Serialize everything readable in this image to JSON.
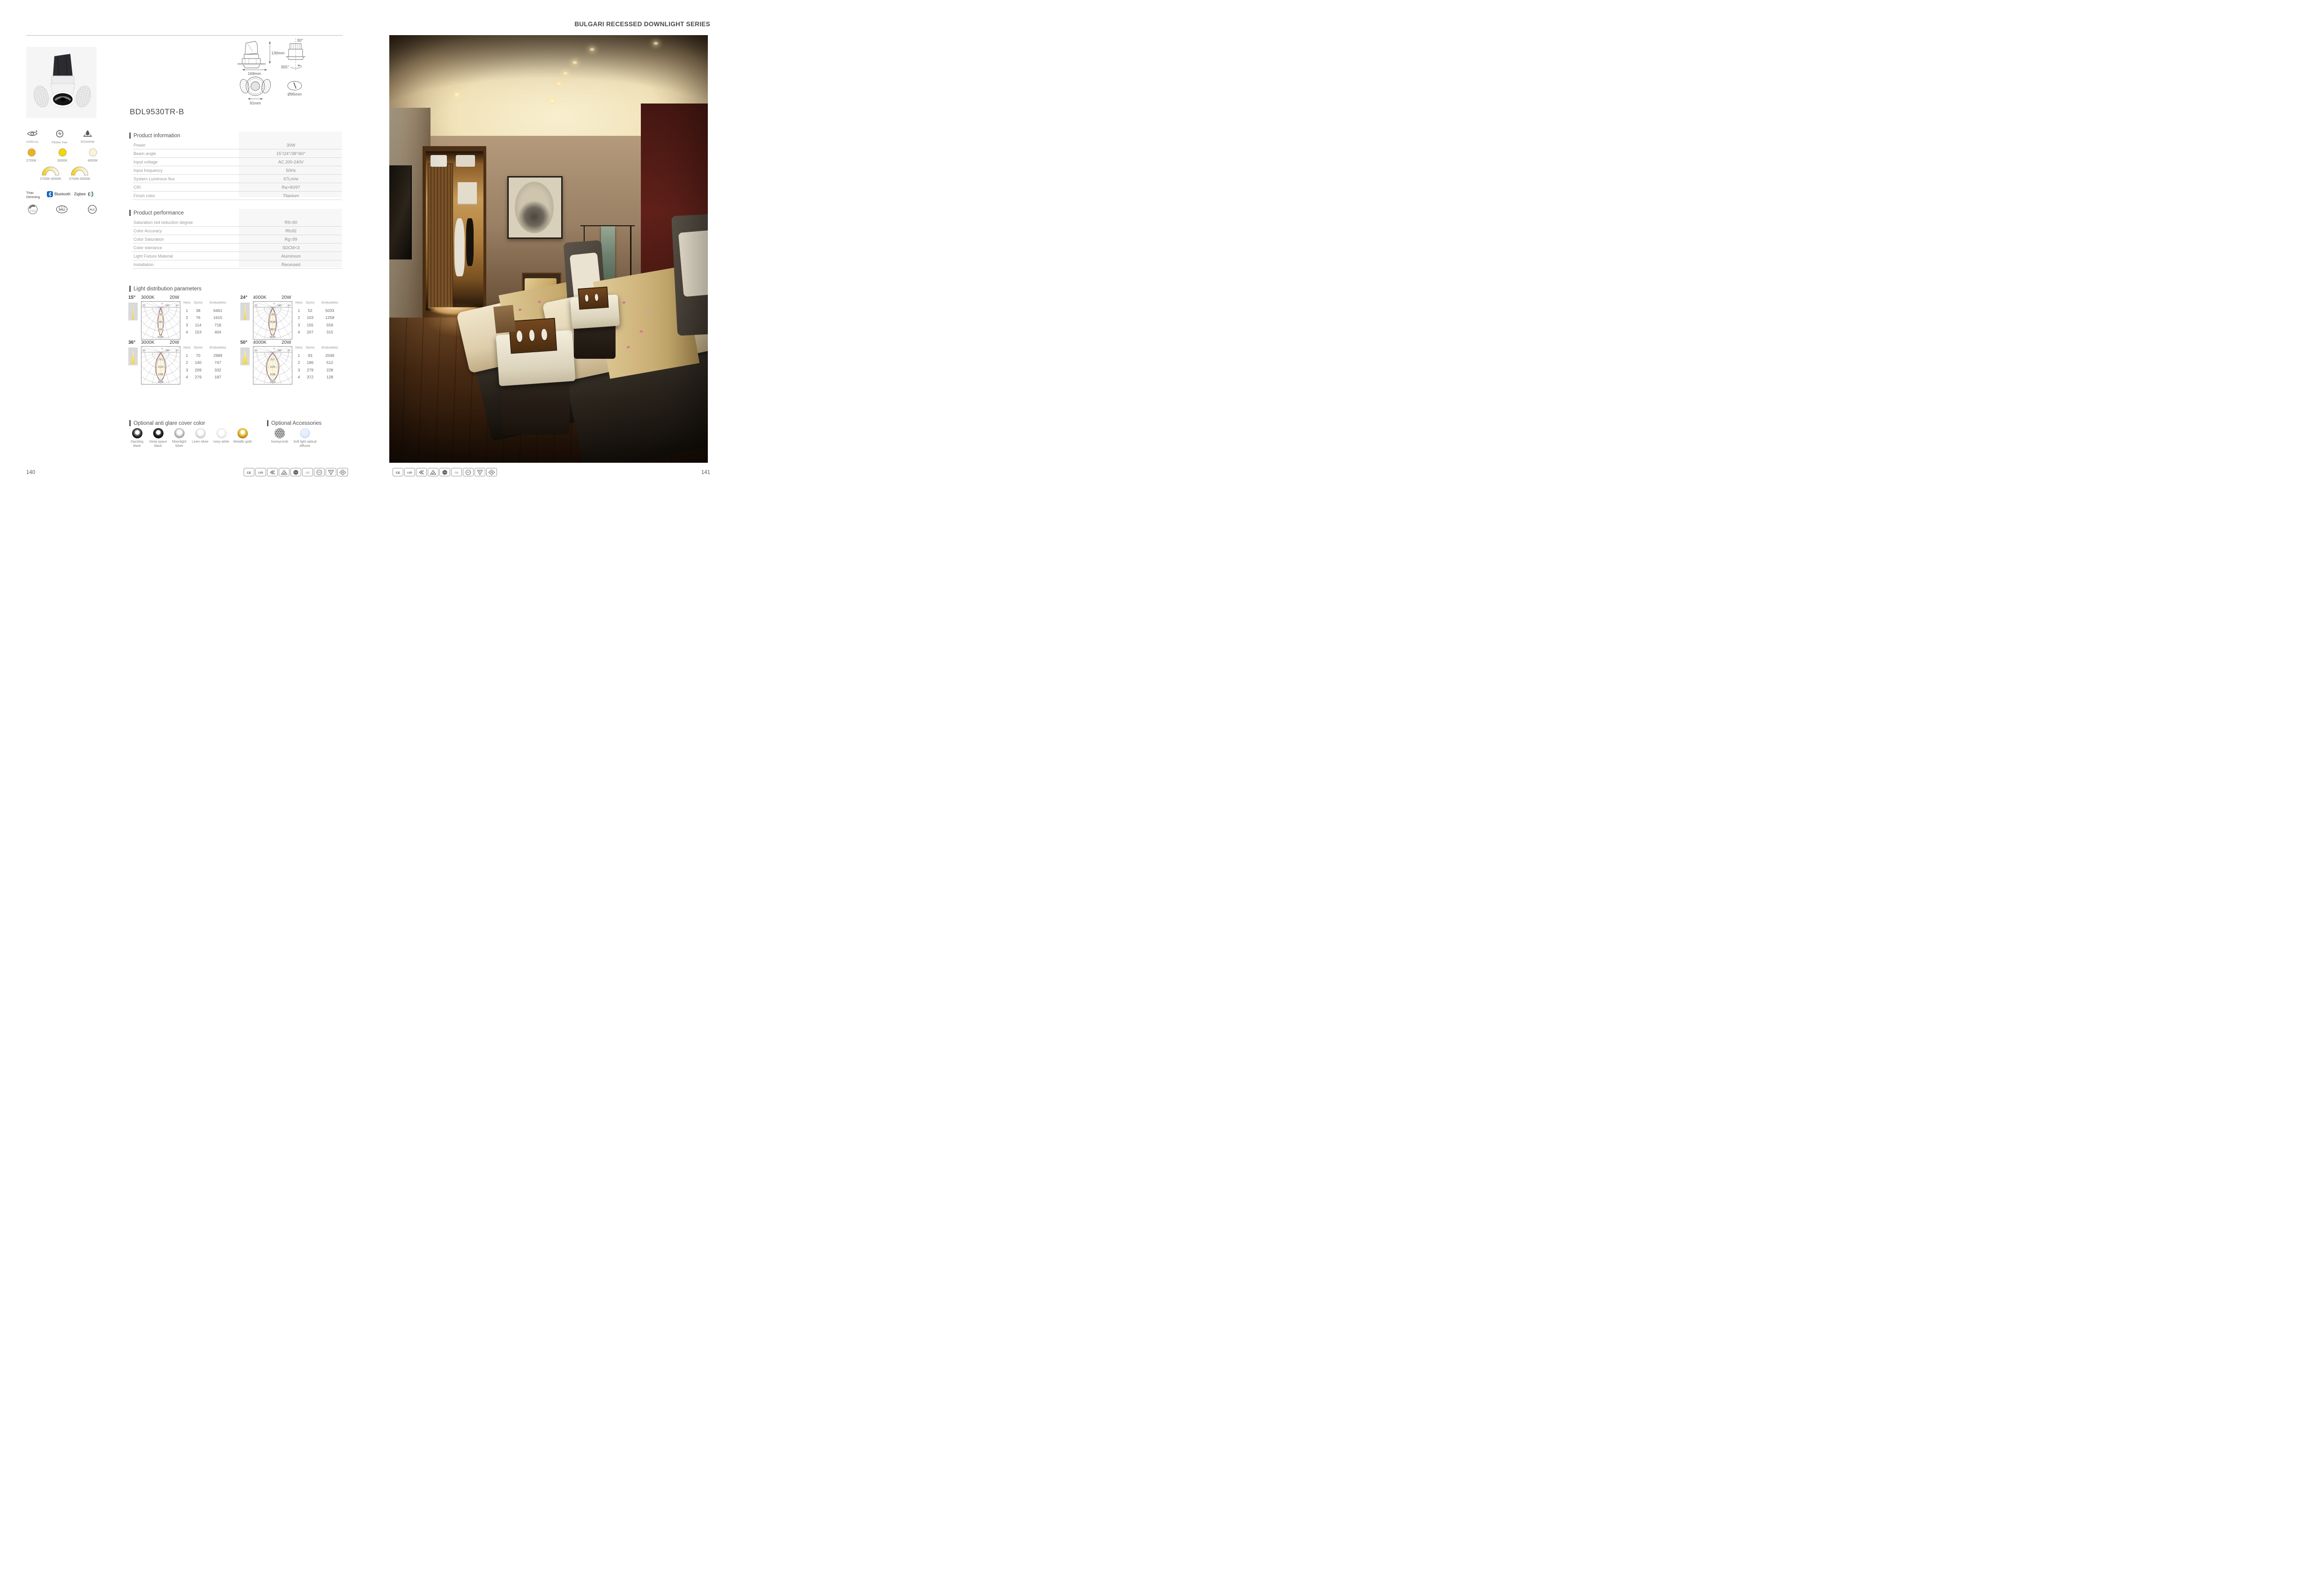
{
  "header": {
    "series_title": "BULGARI RECESSED DOWNLIGHT SERIES"
  },
  "page": {
    "left_number": "140",
    "right_number": "141"
  },
  "product": {
    "model": "BDL9530TR-B",
    "features": [
      {
        "icon": "ugr-eye-icon",
        "label": "UGR<11"
      },
      {
        "icon": "flicker-free-icon",
        "label": "Flicker free"
      },
      {
        "icon": "waterproof-icon",
        "label": "IP20/IP65"
      }
    ],
    "cct_options": [
      {
        "label": "2700K",
        "color": "#eeb120"
      },
      {
        "label": "3000K",
        "color": "#f3d900"
      },
      {
        "label": "4000K",
        "color": "#faf3d8"
      }
    ],
    "cct_ranges": [
      {
        "label": "2700K-6000K"
      },
      {
        "label": "2700K-6500K"
      }
    ],
    "dimming": {
      "triac": "Triac Dimming",
      "bluetooth": "Bluetooth",
      "zigbee": "Zigbee",
      "v0_10": "0~10V",
      "dali": "DALI",
      "plc": "PLC"
    },
    "bluetooth_blue": "#1565c0"
  },
  "drawings": {
    "height_label": "130mm",
    "width_label": "169mm",
    "tilt_label": "30°",
    "rotation_label": "355°",
    "face_label": "91mm",
    "cutout_label": "Ø95mm"
  },
  "product_information": {
    "title": "Product information",
    "rows": [
      {
        "label": "Power",
        "value": "30W"
      },
      {
        "label": "Beam angle",
        "value": "15°/24°/38°/60°"
      },
      {
        "label": "Input voltage",
        "value": "AC 200-240V"
      },
      {
        "label": "Input frequency",
        "value": "50Hz"
      },
      {
        "label": "System Luminous flux",
        "value": "67Lm/w"
      },
      {
        "label": "CRI",
        "value": "Ra>90/97"
      },
      {
        "label": "Finish color",
        "value": "Titanium"
      }
    ]
  },
  "product_performance": {
    "title": "Product performance",
    "rows": [
      {
        "label": "Saturation red reduction degree",
        "value": "R9=90"
      },
      {
        "label": "Color Accuracy",
        "value": "Rf≥92"
      },
      {
        "label": "Color Saturation",
        "value": "Rg=99"
      },
      {
        "label": "Color tolerance",
        "value": "SDCM<3"
      },
      {
        "label": "Light Fixture Material",
        "value": "Aluminium"
      },
      {
        "label": "Installation",
        "value": "Recessed"
      }
    ]
  },
  "light_distribution": {
    "title": "Light distribution parameters",
    "col_headers": [
      "H(m)",
      "D(cm)",
      "Em(lux/klm)"
    ],
    "angle_labels": {
      "zero": "0°",
      "ninety": "90°",
      "oneeighty": "180°"
    },
    "diagrams": [
      {
        "beam": "15°",
        "cct": "3000K",
        "power": "20W",
        "ring_values": [
          1681,
          3362,
          5043,
          6724
        ],
        "rows": [
          [
            "1",
            "38",
            "6461"
          ],
          [
            "2",
            "76",
            "1615"
          ],
          [
            "3",
            "114",
            "718"
          ],
          [
            "4",
            "153",
            "404"
          ]
        ]
      },
      {
        "beam": "24°",
        "cct": "4000K",
        "power": "20W",
        "ring_values": [
          1269,
          2538,
          3807,
          5076
        ],
        "rows": [
          [
            "1",
            "52",
            "5033"
          ],
          [
            "2",
            "103",
            "1258"
          ],
          [
            "3",
            "155",
            "559"
          ],
          [
            "4",
            "207",
            "315"
          ]
        ]
      },
      {
        "beam": "36°",
        "cct": "3000K",
        "power": "20W",
        "ring_values": [
          761,
          1523,
          2285,
          3046
        ],
        "rows": [
          [
            "1",
            "70",
            "2989"
          ],
          [
            "2",
            "140",
            "747"
          ],
          [
            "3",
            "209",
            "332"
          ],
          [
            "4",
            "279",
            "187"
          ]
        ]
      },
      {
        "beam": "50°",
        "cct": "4000K",
        "power": "20W",
        "ring_values": [
          512,
          1025,
          1538,
          2050
        ],
        "rows": [
          [
            "1",
            "93",
            "2049"
          ],
          [
            "2",
            "186",
            "512"
          ],
          [
            "3",
            "279",
            "228"
          ],
          [
            "4",
            "372",
            "128"
          ]
        ]
      }
    ]
  },
  "anti_glare": {
    "title": "Optional anti glare cover color",
    "options": [
      {
        "key": "dazzling",
        "label": "Dazzling black"
      },
      {
        "key": "deepspace",
        "label": "Deep space black"
      },
      {
        "key": "moonlight",
        "label": "Moonlight Silver"
      },
      {
        "key": "linen",
        "label": "Linen silver"
      },
      {
        "key": "ivory",
        "label": "Ivory white"
      },
      {
        "key": "gold",
        "label": "Metallic gold"
      }
    ]
  },
  "accessories": {
    "title": "Optional Accessories",
    "options": [
      {
        "key": "honeycomb",
        "label": "honeycomb"
      },
      {
        "key": "softlight",
        "label": "Soft light optical diffuser"
      }
    ]
  },
  "certifications": [
    {
      "id": "CE",
      "label": "CE"
    },
    {
      "id": "LVD",
      "label": "LVD"
    },
    {
      "id": "EMC",
      "label": "EMC"
    },
    {
      "id": "RCM",
      "label": "RCM"
    },
    {
      "id": "TUV",
      "label": "TÜV"
    },
    {
      "id": "GB",
      "label": "GB"
    },
    {
      "id": "CCC",
      "label": "CCC"
    },
    {
      "id": "F",
      "label": "F"
    },
    {
      "id": "III",
      "label": "III"
    }
  ]
}
